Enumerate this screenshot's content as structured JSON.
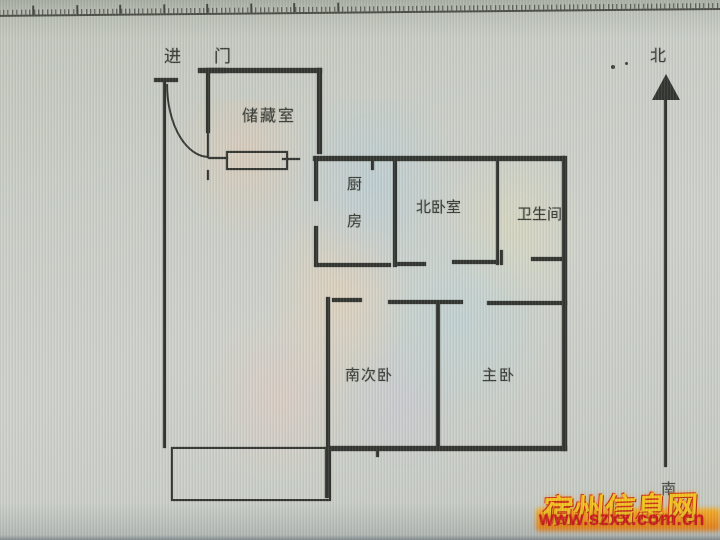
{
  "ruler": {
    "unit_labels": [
      "50",
      "100",
      "150",
      "200",
      "250",
      "300",
      "350",
      "400"
    ],
    "first_x": 44,
    "major_spacing": 43.5,
    "minor_spacing": 4.35,
    "minor_height": 5,
    "major_height": 9
  },
  "floor_plan": {
    "ink": "#2f312d",
    "labels": [
      {
        "name": "entry-label",
        "text": "进门",
        "x": 164,
        "y": 42,
        "size": 17,
        "ls": 33
      },
      {
        "name": "storage-room-label",
        "text": "储藏室",
        "x": 242,
        "y": 102,
        "size": 16,
        "ls": 2
      },
      {
        "name": "kitchen-label",
        "text": "厨房",
        "x": 343,
        "y": 176,
        "size": 15,
        "ls": 22,
        "vertical": true
      },
      {
        "name": "north-bedroom-label",
        "text": "北卧室",
        "x": 416,
        "y": 196,
        "size": 15,
        "ls": 0
      },
      {
        "name": "bathroom-label",
        "text": "卫生间",
        "x": 517,
        "y": 203,
        "size": 15,
        "ls": 0
      },
      {
        "name": "south-bedroom-label",
        "text": "南次卧",
        "x": 345,
        "y": 364,
        "size": 15,
        "ls": 1
      },
      {
        "name": "master-bedroom-label",
        "text": "主卧",
        "x": 482,
        "y": 364,
        "size": 15,
        "ls": 2
      },
      {
        "name": "compass-north-label",
        "text": "北",
        "x": 650,
        "y": 42,
        "size": 16,
        "ls": 0
      },
      {
        "name": "compass-south-label",
        "text": "南",
        "x": 661,
        "y": 478,
        "size": 15,
        "ls": 0,
        "color": "#4a4c46"
      }
    ],
    "walls": [
      {
        "name": "outer-left-wall",
        "kind": "solid",
        "x": 163,
        "y": 80,
        "w": 3,
        "h": 368
      },
      {
        "name": "outer-left-wall-cap",
        "kind": "solid",
        "x": 154,
        "y": 78,
        "w": 24,
        "h": 4
      },
      {
        "name": "entry-door-arc",
        "kind": "arc",
        "x": 166,
        "y": 84,
        "w": 41,
        "h": 72
      },
      {
        "name": "entry-door-leaf",
        "kind": "solid",
        "x": 206,
        "y": 71,
        "w": 4,
        "h": 62
      },
      {
        "name": "entry-door-leaf-lower",
        "kind": "solid",
        "x": 207,
        "y": 133,
        "w": 2,
        "h": 25
      },
      {
        "name": "entry-door-top-cap",
        "kind": "solid",
        "x": 198,
        "y": 68,
        "w": 28,
        "h": 5
      },
      {
        "name": "storage-north-wall",
        "kind": "solid",
        "x": 206,
        "y": 68,
        "w": 116,
        "h": 5
      },
      {
        "name": "storage-east-wall",
        "kind": "solid",
        "x": 317,
        "y": 68,
        "w": 5,
        "h": 86
      },
      {
        "name": "storage-south-ledge",
        "kind": "solid",
        "x": 208,
        "y": 157,
        "w": 20,
        "h": 2
      },
      {
        "name": "storage-window",
        "kind": "outline",
        "x": 226,
        "y": 151,
        "w": 58,
        "h": 15
      },
      {
        "name": "storage-window-midline",
        "kind": "solid",
        "x": 282,
        "y": 158,
        "w": 18,
        "h": 2
      },
      {
        "name": "wall-paint-mark",
        "kind": "solid",
        "x": 207,
        "y": 170,
        "w": 2,
        "h": 10
      },
      {
        "name": "north-wall",
        "kind": "solid",
        "x": 313,
        "y": 156,
        "w": 252,
        "h": 5
      },
      {
        "name": "north-wall-tick",
        "kind": "solid",
        "x": 371,
        "y": 161,
        "w": 3,
        "h": 9
      },
      {
        "name": "kitchen-west-wall-upper",
        "kind": "solid",
        "x": 314,
        "y": 161,
        "w": 4,
        "h": 40
      },
      {
        "name": "kitchen-west-wall-lower",
        "kind": "solid",
        "x": 314,
        "y": 226,
        "w": 4,
        "h": 41
      },
      {
        "name": "kitchen-south-wall",
        "kind": "solid",
        "x": 316,
        "y": 263,
        "w": 75,
        "h": 4
      },
      {
        "name": "kitchen-bedroom-divider",
        "kind": "solid",
        "x": 393,
        "y": 158,
        "w": 4,
        "h": 109
      },
      {
        "name": "north-bedroom-south-wall-left",
        "kind": "solid",
        "x": 396,
        "y": 262,
        "w": 30,
        "h": 4
      },
      {
        "name": "north-bedroom-south-wall-right",
        "kind": "solid",
        "x": 452,
        "y": 260,
        "w": 47,
        "h": 4
      },
      {
        "name": "bathroom-west-wall",
        "kind": "solid",
        "x": 496,
        "y": 157,
        "w": 3,
        "h": 108
      },
      {
        "name": "bathroom-door-jamb",
        "kind": "solid",
        "x": 500,
        "y": 250,
        "w": 3,
        "h": 15
      },
      {
        "name": "bathroom-south-wall",
        "kind": "solid",
        "x": 531,
        "y": 257,
        "w": 34,
        "h": 4
      },
      {
        "name": "outer-east-wall",
        "kind": "solid",
        "x": 562,
        "y": 156,
        "w": 5,
        "h": 295
      },
      {
        "name": "south-bedroom-west-wall",
        "kind": "solid",
        "x": 326,
        "y": 297,
        "w": 4,
        "h": 151
      },
      {
        "name": "south-bedroom-north-wall-left",
        "kind": "solid",
        "x": 332,
        "y": 298,
        "w": 30,
        "h": 4
      },
      {
        "name": "south-bedroom-north-wall-right",
        "kind": "solid",
        "x": 388,
        "y": 300,
        "w": 75,
        "h": 4
      },
      {
        "name": "bedroom-divider-wall",
        "kind": "solid",
        "x": 436,
        "y": 301,
        "w": 4,
        "h": 147
      },
      {
        "name": "master-bedroom-north-wall",
        "kind": "solid",
        "x": 487,
        "y": 301,
        "w": 80,
        "h": 4
      },
      {
        "name": "outer-south-wall",
        "kind": "solid",
        "x": 329,
        "y": 446,
        "w": 238,
        "h": 5
      },
      {
        "name": "south-wall-tick",
        "kind": "solid",
        "x": 376,
        "y": 450,
        "w": 3,
        "h": 7
      },
      {
        "name": "balcony",
        "kind": "outline",
        "x": 171,
        "y": 447,
        "w": 156,
        "h": 50
      },
      {
        "name": "balcony-east-wall",
        "kind": "solid",
        "x": 325,
        "y": 447,
        "w": 5,
        "h": 51
      },
      {
        "name": "north-arrow-head",
        "kind": "arrowhead",
        "x": 652,
        "y": 74,
        "w": 28,
        "h": 26
      },
      {
        "name": "north-arrow-stem",
        "kind": "solid",
        "x": 664,
        "y": 98,
        "w": 3,
        "h": 369
      },
      {
        "name": "speck-dot-1",
        "kind": "dot",
        "x": 611,
        "y": 65,
        "w": 4,
        "h": 4
      },
      {
        "name": "speck-dot-2",
        "kind": "dot",
        "x": 625,
        "y": 62,
        "w": 3,
        "h": 3
      }
    ]
  },
  "watermark": {
    "site_name": "宿州信息网",
    "url": "www.szxx.com.cn",
    "gold_color": "#f6c31c",
    "red_color": "#dc1010"
  }
}
